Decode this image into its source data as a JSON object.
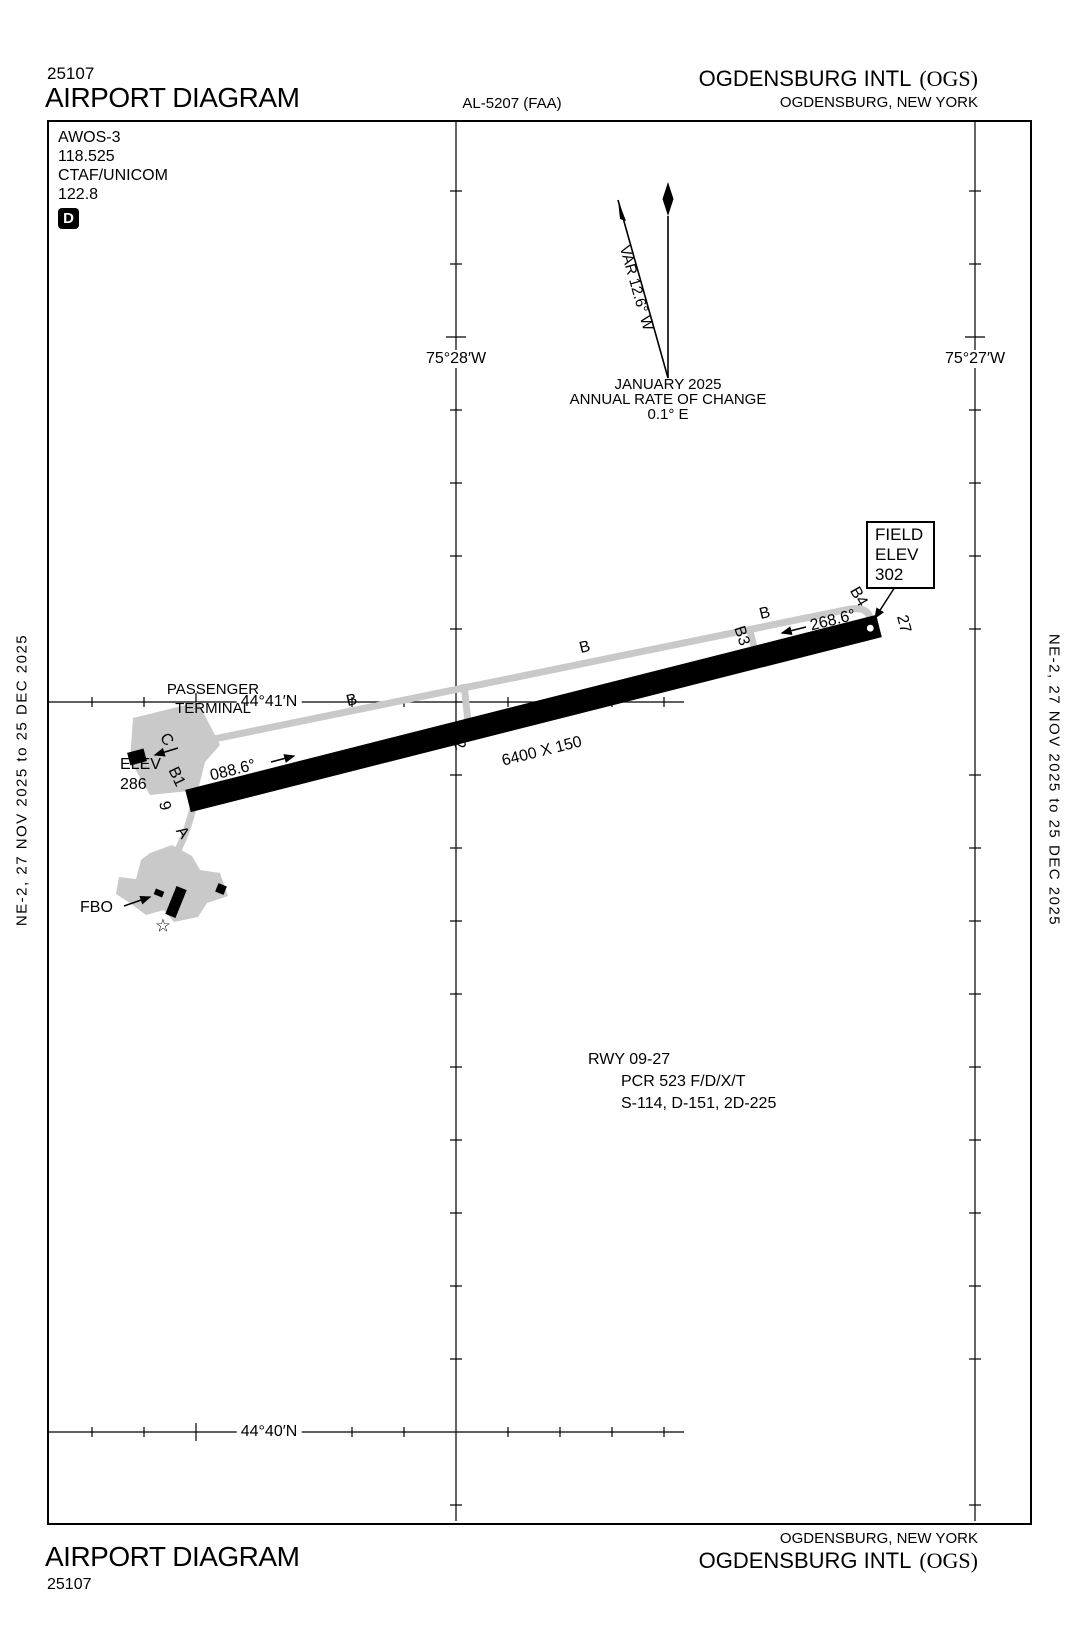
{
  "header": {
    "procedure_number": "25107",
    "title": "AIRPORT DIAGRAM",
    "al_ref": "AL-5207 (FAA)",
    "airport_name": "OGDENSBURG INTL",
    "airport_code": "(OGS)",
    "location": "OGDENSBURG, NEW YORK"
  },
  "footer": {
    "title": "AIRPORT DIAGRAM",
    "procedure_number": "25107",
    "airport_name": "OGDENSBURG INTL",
    "airport_code": "(OGS)",
    "location": "OGDENSBURG, NEW YORK"
  },
  "edge_bands": {
    "left": "NE-2, 27 NOV 2025 to 25 DEC 2025",
    "right": "NE-2, 27 NOV 2025 to 25 DEC 2025"
  },
  "comms": {
    "lines": [
      "AWOS-3",
      "118.525",
      "CTAF/UNICOM",
      "122.8"
    ],
    "symbol": "D"
  },
  "north_note": {
    "variation": "VAR 12.6° W",
    "date": "JANUARY 2025",
    "rate_label": "ANNUAL RATE OF CHANGE",
    "rate_value": "0.1° E"
  },
  "graticule": {
    "lon_labels": [
      "75°28′W",
      "75°27′W"
    ],
    "lat_labels": [
      "44°41′N",
      "44°40′N"
    ]
  },
  "field_elevation": {
    "line1": "FIELD",
    "line2": "ELEV",
    "value": "302"
  },
  "runway": {
    "size": "6400 X 150",
    "id": "RWY 09-27",
    "pcr": "PCR 523 F/D/X/T",
    "strength": "S-114, D-151, 2D-225",
    "heading_e": "088.6°",
    "heading_w": "268.6°",
    "end_w": "9",
    "end_e": "27",
    "elev_label": "ELEV",
    "elev_value": "286"
  },
  "features": {
    "terminal_line1": "PASSENGER",
    "terminal_line2": "TERMINAL",
    "fbo": "FBO",
    "beacon": "☆"
  },
  "taxiway_labels": [
    {
      "t": "B",
      "x": 352,
      "y": 701,
      "r": -14
    },
    {
      "t": "B",
      "x": 585,
      "y": 648,
      "r": -14
    },
    {
      "t": "B",
      "x": 765,
      "y": 614,
      "r": -14
    },
    {
      "t": "B1",
      "x": 176,
      "y": 777,
      "r": 65
    },
    {
      "t": "B2",
      "x": 457,
      "y": 740,
      "r": 72
    },
    {
      "t": "B3",
      "x": 741,
      "y": 636,
      "r": 72
    },
    {
      "t": "B4",
      "x": 858,
      "y": 597,
      "r": 60
    },
    {
      "t": "C",
      "x": 166,
      "y": 740,
      "r": 55
    },
    {
      "t": "A",
      "x": 182,
      "y": 833,
      "r": 55
    }
  ]
}
